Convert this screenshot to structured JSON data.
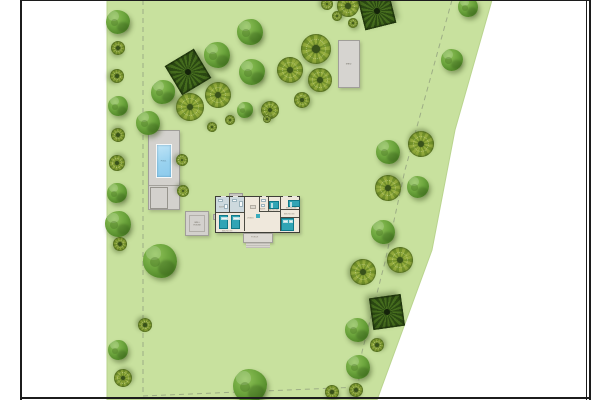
{
  "page": {
    "background": "#ffffff",
    "frame_color": "#1c1c1c"
  },
  "parcel": {
    "fill": "#c8e19e",
    "edge": "#b9d48e",
    "points": "107,0 492,0 455,130 432,250 377,400 107,400"
  },
  "boundary_lines": {
    "color": "#9dad85",
    "dash": "5,4",
    "west": {
      "points": "143,0 143,396"
    },
    "south": {
      "points": "143,396 360,387"
    },
    "east": {
      "points": "452,0 405,170 385,262 362,352 358,387"
    }
  },
  "structures": {
    "pool": {
      "label": "POOL"
    },
    "shed": {
      "label": "SHED"
    },
    "well_house": {
      "label_line1": "WELL",
      "label_line2": "HOUSE"
    }
  },
  "house": {
    "room_labels": {
      "bath_left": "BATH",
      "bath_mid": "BATH",
      "bedroom_left": "BEDROOM",
      "living": "LIVING",
      "bedroom_mid": "BEDROOM",
      "bedroom_top_right": "BEDROOM",
      "bedroom_right": "BEDROOM",
      "porch": "PORCH"
    }
  },
  "tree_palette": {
    "fluffy_mid": "#6ba43c",
    "fluffy_dark": "#447423",
    "ornamental_light": "#96ae3e",
    "ornamental_dark": "#75942c",
    "palm_dark": "#2c4a13",
    "palm_mid": "#466d1e"
  },
  "trees": [
    {
      "x": 118,
      "y": 22,
      "r": 12,
      "type": "fluffy"
    },
    {
      "x": 118,
      "y": 48,
      "r": 7,
      "type": "patterned"
    },
    {
      "x": 117,
      "y": 76,
      "r": 7,
      "type": "patterned"
    },
    {
      "x": 118,
      "y": 106,
      "r": 10,
      "type": "fluffy"
    },
    {
      "x": 118,
      "y": 135,
      "r": 7,
      "type": "patterned"
    },
    {
      "x": 117,
      "y": 163,
      "r": 8,
      "type": "patterned"
    },
    {
      "x": 117,
      "y": 193,
      "r": 10,
      "type": "fluffy"
    },
    {
      "x": 118,
      "y": 224,
      "r": 13,
      "type": "fluffy"
    },
    {
      "x": 120,
      "y": 244,
      "r": 7,
      "type": "patterned"
    },
    {
      "x": 160,
      "y": 261,
      "r": 17,
      "type": "fluffy"
    },
    {
      "x": 145,
      "y": 325,
      "r": 7,
      "type": "patterned"
    },
    {
      "x": 118,
      "y": 350,
      "r": 10,
      "type": "fluffy"
    },
    {
      "x": 123,
      "y": 378,
      "r": 9,
      "type": "patterned"
    },
    {
      "x": 188,
      "y": 72,
      "r": 17,
      "type": "palmate"
    },
    {
      "x": 163,
      "y": 92,
      "r": 12,
      "type": "fluffy"
    },
    {
      "x": 148,
      "y": 123,
      "r": 12,
      "type": "fluffy"
    },
    {
      "x": 190,
      "y": 107,
      "r": 14,
      "type": "patterned"
    },
    {
      "x": 217,
      "y": 55,
      "r": 13,
      "type": "fluffy"
    },
    {
      "x": 218,
      "y": 95,
      "r": 13,
      "type": "patterned"
    },
    {
      "x": 250,
      "y": 32,
      "r": 13,
      "type": "fluffy"
    },
    {
      "x": 252,
      "y": 72,
      "r": 13,
      "type": "fluffy"
    },
    {
      "x": 290,
      "y": 70,
      "r": 13,
      "type": "patterned"
    },
    {
      "x": 245,
      "y": 110,
      "r": 8,
      "type": "fluffy"
    },
    {
      "x": 270,
      "y": 110,
      "r": 9,
      "type": "patterned"
    },
    {
      "x": 212,
      "y": 127,
      "r": 5,
      "type": "patterned"
    },
    {
      "x": 230,
      "y": 120,
      "r": 5,
      "type": "patterned"
    },
    {
      "x": 267,
      "y": 119,
      "r": 4,
      "type": "patterned"
    },
    {
      "x": 302,
      "y": 100,
      "r": 8,
      "type": "patterned"
    },
    {
      "x": 316,
      "y": 49,
      "r": 15,
      "type": "patterned"
    },
    {
      "x": 320,
      "y": 80,
      "r": 12,
      "type": "patterned"
    },
    {
      "x": 327,
      "y": 4,
      "r": 6,
      "type": "patterned"
    },
    {
      "x": 348,
      "y": 6,
      "r": 11,
      "type": "patterned"
    },
    {
      "x": 377,
      "y": 11,
      "r": 16,
      "type": "palmate"
    },
    {
      "x": 337,
      "y": 16,
      "r": 5,
      "type": "patterned"
    },
    {
      "x": 353,
      "y": 23,
      "r": 5,
      "type": "patterned"
    },
    {
      "x": 468,
      "y": 7,
      "r": 10,
      "type": "fluffy"
    },
    {
      "x": 452,
      "y": 60,
      "r": 11,
      "type": "fluffy"
    },
    {
      "x": 388,
      "y": 152,
      "r": 12,
      "type": "fluffy"
    },
    {
      "x": 421,
      "y": 144,
      "r": 13,
      "type": "patterned"
    },
    {
      "x": 388,
      "y": 188,
      "r": 13,
      "type": "patterned"
    },
    {
      "x": 418,
      "y": 187,
      "r": 11,
      "type": "fluffy"
    },
    {
      "x": 383,
      "y": 232,
      "r": 12,
      "type": "fluffy"
    },
    {
      "x": 400,
      "y": 260,
      "r": 13,
      "type": "patterned"
    },
    {
      "x": 363,
      "y": 272,
      "r": 13,
      "type": "patterned"
    },
    {
      "x": 387,
      "y": 312,
      "r": 16,
      "type": "palmate"
    },
    {
      "x": 357,
      "y": 330,
      "r": 12,
      "type": "fluffy"
    },
    {
      "x": 377,
      "y": 345,
      "r": 7,
      "type": "patterned"
    },
    {
      "x": 358,
      "y": 367,
      "r": 12,
      "type": "fluffy"
    },
    {
      "x": 332,
      "y": 392,
      "r": 7,
      "type": "patterned"
    },
    {
      "x": 356,
      "y": 390,
      "r": 7,
      "type": "patterned"
    },
    {
      "x": 182,
      "y": 160,
      "r": 6,
      "type": "patterned"
    },
    {
      "x": 183,
      "y": 191,
      "r": 6,
      "type": "patterned"
    },
    {
      "x": 250,
      "y": 386,
      "r": 17,
      "type": "fluffy"
    }
  ]
}
